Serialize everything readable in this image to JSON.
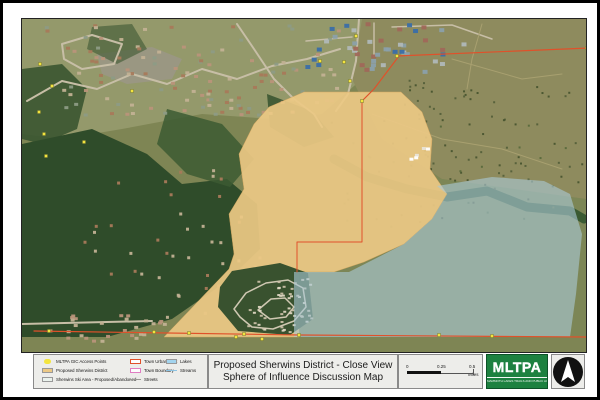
{
  "title_block": {
    "line1": "Proposed Sherwins District - Close View",
    "line2": "Sphere of Influence Discussion Map"
  },
  "legend": {
    "columns": [
      {
        "items": [
          {
            "label": "MLTPA GIC Access Points",
            "swatch": "point",
            "color": "#f3e53e"
          },
          {
            "label": "Proposed Sherwins District",
            "swatch": "fill",
            "color": "#ecc985"
          },
          {
            "label": "Sherwins Ski Area - Proposed/Abandoned",
            "swatch": "fill",
            "color": "#eaf2ec"
          }
        ]
      },
      {
        "items": [
          {
            "label": "Town Urban Limit",
            "swatch": "outline",
            "color": "#e0512a"
          },
          {
            "label": "Town Boundary",
            "swatch": "outline",
            "color": "#e07ec2"
          },
          {
            "label": "Streets",
            "swatch": "line",
            "color": "#9a9a94"
          }
        ]
      },
      {
        "items": [
          {
            "label": "Lakes",
            "swatch": "fill",
            "color": "#a3d4ee"
          },
          {
            "label": "Streams",
            "swatch": "line",
            "color": "#8cc3e2"
          }
        ]
      }
    ]
  },
  "scale_bar": {
    "labels": [
      "0",
      "0.25",
      "0.5"
    ],
    "unit": "Miles"
  },
  "logo": {
    "text": "MLTPA",
    "subtext": "MAMMOTH LAKES TRAILS AND PUBLIC ACCESS",
    "bg": "#1d8140"
  },
  "north_arrow": {
    "name": "north-arrow"
  },
  "colors": {
    "district_fill": "#ecc985",
    "ski_area_fill": "#aac8d5",
    "urban_limit_line": "#e0512a",
    "access_point": "#f3e53e",
    "forest": "#2f4c2a",
    "scrub": "#8e8b5e"
  },
  "map": {
    "width": 564,
    "height": 333,
    "layers": [
      {
        "t": "rect",
        "x": 0,
        "y": 0,
        "w": 564,
        "h": 333,
        "fill": "#7e8554"
      },
      {
        "t": "poly",
        "pts": [
          [
            0,
            0
          ],
          [
            360,
            0
          ],
          [
            340,
            60
          ],
          [
            300,
            95
          ],
          [
            250,
            100
          ],
          [
            180,
            95
          ],
          [
            100,
            110
          ],
          [
            40,
            120
          ],
          [
            0,
            115
          ]
        ],
        "fill": "#94996b"
      },
      {
        "t": "poly",
        "pts": [
          [
            340,
            0
          ],
          [
            564,
            0
          ],
          [
            564,
            180
          ],
          [
            480,
            170
          ],
          [
            420,
            160
          ],
          [
            360,
            120
          ],
          [
            330,
            60
          ]
        ],
        "fill": "#8e8b5e"
      },
      {
        "t": "poly",
        "pts": [
          [
            300,
            150
          ],
          [
            420,
            160
          ],
          [
            564,
            180
          ],
          [
            564,
            318
          ],
          [
            272,
            318
          ],
          [
            272,
            200
          ]
        ],
        "fill": "#7c8656"
      },
      {
        "t": "poly",
        "pts": [
          [
            75,
            35
          ],
          [
            130,
            28
          ],
          [
            160,
            40
          ],
          [
            150,
            60
          ],
          [
            105,
            65
          ],
          [
            80,
            55
          ]
        ],
        "fill": "#9b9786",
        "opacity": 0.85
      },
      {
        "t": "poly",
        "pts": [
          [
            0,
            50
          ],
          [
            40,
            45
          ],
          [
            65,
            70
          ],
          [
            55,
            110
          ],
          [
            20,
            125
          ],
          [
            0,
            120
          ]
        ],
        "fill": "#3a5531",
        "opacity": 0.9
      },
      {
        "t": "poly",
        "pts": [
          [
            0,
            125
          ],
          [
            70,
            110
          ],
          [
            125,
            135
          ],
          [
            160,
            165
          ],
          [
            205,
            160
          ],
          [
            235,
            185
          ],
          [
            238,
            230
          ],
          [
            205,
            262
          ],
          [
            150,
            300
          ],
          [
            85,
            318
          ],
          [
            0,
            318
          ]
        ],
        "fill": "#2f4c2a"
      },
      {
        "t": "poly",
        "pts": [
          [
            145,
            90
          ],
          [
            200,
            105
          ],
          [
            232,
            140
          ],
          [
            208,
            168
          ],
          [
            165,
            155
          ],
          [
            135,
            125
          ]
        ],
        "fill": "#3c5a33",
        "opacity": 0.85
      },
      {
        "t": "poly",
        "pts": [
          [
            245,
            75
          ],
          [
            290,
            92
          ],
          [
            312,
            118
          ],
          [
            282,
            128
          ],
          [
            248,
            108
          ]
        ],
        "fill": "#36522e",
        "opacity": 0.85
      },
      {
        "t": "poly",
        "pts": [
          [
            70,
            8
          ],
          [
            110,
            5
          ],
          [
            125,
            30
          ],
          [
            95,
            45
          ],
          [
            65,
            30
          ]
        ],
        "fill": "#49603a",
        "opacity": 0.7
      },
      {
        "t": "line",
        "pts": [
          [
            312,
            140
          ],
          [
            345,
            158
          ],
          [
            385,
            170
          ],
          [
            425,
            178
          ],
          [
            465,
            172
          ],
          [
            505,
            188
          ],
          [
            548,
            192
          ],
          [
            562,
            200
          ]
        ],
        "stroke": "#33552f",
        "sw": 9,
        "opacity": 0.9
      },
      {
        "t": "line",
        "pts": [
          [
            5,
            82
          ],
          [
            40,
            62
          ],
          [
            75,
            70
          ],
          [
            110,
            55
          ],
          [
            145,
            65
          ],
          [
            180,
            50
          ],
          [
            215,
            60
          ],
          [
            250,
            47
          ],
          [
            285,
            40
          ],
          [
            318,
            30
          ]
        ],
        "stroke": "#c7bea6",
        "sw": 2
      },
      {
        "t": "line",
        "pts": [
          [
            40,
            25
          ],
          [
            70,
            16
          ],
          [
            100,
            25
          ],
          [
            92,
            45
          ],
          [
            60,
            50
          ],
          [
            42,
            40
          ],
          [
            40,
            25
          ]
        ],
        "stroke": "#c7bea6",
        "sw": 2
      },
      {
        "t": "line",
        "pts": [
          [
            215,
            5
          ],
          [
            232,
            30
          ],
          [
            252,
            60
          ],
          [
            272,
            80
          ],
          [
            292,
            95
          ],
          [
            300,
            108
          ]
        ],
        "stroke": "#c7bea6",
        "sw": 2
      },
      {
        "t": "line",
        "pts": [
          [
            337,
            0
          ],
          [
            334,
            42
          ],
          [
            326,
            75
          ],
          [
            314,
            92
          ]
        ],
        "stroke": "#c7bea6",
        "sw": 2
      },
      {
        "t": "line",
        "pts": [
          [
            0,
            305
          ],
          [
            130,
            302
          ]
        ],
        "stroke": "#c7bea6",
        "sw": 2
      },
      {
        "t": "line",
        "pts": [
          [
            284,
            22
          ],
          [
            330,
            18
          ]
        ],
        "stroke": "#c7bea6",
        "sw": 1.5
      },
      {
        "t": "line",
        "pts": [
          [
            352,
            4
          ],
          [
            352,
            38
          ]
        ],
        "stroke": "#c7bea6",
        "sw": 1.5
      },
      {
        "t": "line",
        "pts": [
          [
            370,
            8
          ],
          [
            430,
            6
          ],
          [
            470,
            20
          ]
        ],
        "stroke": "#c7bea6",
        "sw": 1.5
      },
      {
        "t": "line",
        "pts": [
          [
            430,
            40
          ],
          [
            500,
            60
          ],
          [
            540,
            55
          ]
        ],
        "stroke": "#a8a070",
        "sw": 1
      },
      {
        "t": "line",
        "pts": [
          [
            350,
            95
          ],
          [
            420,
            120
          ],
          [
            480,
            130
          ],
          [
            540,
            150
          ]
        ],
        "stroke": "#a8a070",
        "sw": 1
      },
      {
        "t": "line",
        "pts": [
          [
            460,
            5
          ],
          [
            450,
            40
          ],
          [
            445,
            70
          ]
        ],
        "stroke": "#a8a070",
        "sw": 1
      },
      {
        "t": "scatter",
        "x": 20,
        "y": 5,
        "w": 300,
        "h": 90,
        "n": 120,
        "size": [
          4,
          3
        ],
        "colors": [
          "#a8795a",
          "#c2b193",
          "#8d9b85",
          "#b9937a"
        ],
        "seed": 7
      },
      {
        "t": "scatter",
        "x": 282,
        "y": 2,
        "w": 160,
        "h": 50,
        "n": 45,
        "size": [
          5,
          4
        ],
        "colors": [
          "#8ba0aa",
          "#b0b8b8",
          "#a06858",
          "#3a6ea8"
        ],
        "seed": 11
      },
      {
        "t": "scatter",
        "x": 60,
        "y": 150,
        "w": 180,
        "h": 150,
        "n": 45,
        "size": [
          3,
          3
        ],
        "colors": [
          "#c2b193",
          "#a8795a"
        ],
        "seed": 3
      },
      {
        "t": "scatter",
        "x": 15,
        "y": 295,
        "w": 135,
        "h": 26,
        "n": 28,
        "size": [
          4,
          3
        ],
        "colors": [
          "#b9937a",
          "#c2b193"
        ],
        "seed": 5
      },
      {
        "t": "scatter",
        "x": 380,
        "y": 60,
        "w": 180,
        "h": 110,
        "n": 70,
        "size": [
          2,
          2
        ],
        "colors": [
          "#55603a",
          "#49552f"
        ],
        "seed": 13
      },
      {
        "t": "scatter",
        "x": 300,
        "y": 100,
        "w": 250,
        "h": 110,
        "n": 40,
        "size": [
          2,
          2
        ],
        "colors": [
          "#4a5530",
          "#5a6a3c"
        ],
        "seed": 21
      },
      {
        "t": "poly",
        "pts": [
          [
            282,
            73
          ],
          [
            379,
            73
          ],
          [
            400,
            93
          ],
          [
            410,
            120
          ],
          [
            408,
            150
          ],
          [
            425,
            175
          ],
          [
            410,
            200
          ],
          [
            382,
            225
          ],
          [
            342,
            243
          ],
          [
            312,
            253
          ],
          [
            277,
            253
          ],
          [
            277,
            318
          ],
          [
            142,
            318
          ],
          [
            207,
            250
          ],
          [
            212,
            235
          ],
          [
            207,
            195
          ],
          [
            222,
            170
          ],
          [
            217,
            135
          ],
          [
            232,
            105
          ],
          [
            247,
            88
          ]
        ],
        "fill": "#ecc985",
        "opacity": 0.92,
        "stroke": "#d8a860",
        "sw": 0.5
      },
      {
        "t": "scatter",
        "x": 385,
        "y": 125,
        "w": 28,
        "h": 18,
        "n": 5,
        "size": [
          4,
          3
        ],
        "colors": [
          "#ffffff",
          "#e8e4d8"
        ],
        "seed": 17
      },
      {
        "t": "poly",
        "pts": [
          [
            210,
            252
          ],
          [
            258,
            244
          ],
          [
            286,
            254
          ],
          [
            291,
            300
          ],
          [
            268,
            316
          ],
          [
            216,
            312
          ],
          [
            196,
            288
          ],
          [
            198,
            268
          ]
        ],
        "fill": "#2f4c2a",
        "opacity": 0.95
      },
      {
        "t": "line",
        "pts": [
          [
            212,
            290
          ],
          [
            224,
            274
          ],
          [
            244,
            264
          ],
          [
            266,
            261
          ],
          [
            281,
            269
          ],
          [
            284,
            288
          ],
          [
            272,
            302
          ],
          [
            251,
            310
          ],
          [
            230,
            308
          ],
          [
            218,
            298
          ],
          [
            212,
            290
          ]
        ],
        "stroke": "#cfc8b2",
        "sw": 1.5
      },
      {
        "t": "line",
        "pts": [
          [
            236,
            291
          ],
          [
            249,
            280
          ],
          [
            263,
            279
          ],
          [
            272,
            288
          ],
          [
            264,
            298
          ],
          [
            248,
            300
          ],
          [
            236,
            291
          ]
        ],
        "stroke": "#cfc8b2",
        "sw": 1.5
      },
      {
        "t": "scatter",
        "x": 222,
        "y": 258,
        "w": 68,
        "h": 55,
        "n": 50,
        "size": [
          3,
          2
        ],
        "colors": [
          "#ded6c2",
          "#c9bfa6"
        ],
        "seed": 9
      },
      {
        "t": "poly",
        "pts": [
          [
            415,
            167
          ],
          [
            470,
            158
          ],
          [
            522,
            162
          ],
          [
            548,
            175
          ],
          [
            560,
            215
          ],
          [
            554,
            275
          ],
          [
            548,
            318
          ],
          [
            272,
            318
          ],
          [
            272,
            253
          ],
          [
            327,
            253
          ],
          [
            382,
            225
          ],
          [
            410,
            200
          ],
          [
            425,
            175
          ]
        ],
        "fill": "#aac8d5",
        "opacity": 0.62
      },
      {
        "t": "line",
        "pts": [
          [
            375,
            37
          ],
          [
            567,
            29
          ]
        ],
        "stroke": "#e0512a",
        "sw": 1.2
      },
      {
        "t": "line",
        "pts": [
          [
            377,
            37
          ],
          [
            352,
            70
          ],
          [
            340,
            82
          ]
        ],
        "stroke": "#e0512a",
        "sw": 1.2
      },
      {
        "t": "line",
        "pts": [
          [
            340,
            82
          ],
          [
            340,
            223
          ],
          [
            275,
            223
          ],
          [
            275,
            253
          ]
        ],
        "stroke": "#e0512a",
        "sw": 1
      },
      {
        "t": "line",
        "pts": [
          [
            12,
            312
          ],
          [
            277,
            316
          ],
          [
            564,
            318
          ]
        ],
        "stroke": "#e0512a",
        "sw": 1.2
      },
      {
        "t": "pts",
        "size": 3,
        "fill": "#f3e53e",
        "stroke": "#7a7a30",
        "pts": [
          [
            375,
            37
          ],
          [
            565,
            29
          ],
          [
            18,
            45
          ],
          [
            30,
            67
          ],
          [
            17,
            93
          ],
          [
            22,
            115
          ],
          [
            24,
            137
          ],
          [
            62,
            123
          ],
          [
            110,
            72
          ],
          [
            334,
            17
          ],
          [
            298,
            42
          ],
          [
            322,
            43
          ],
          [
            328,
            62
          ],
          [
            340,
            82
          ],
          [
            27,
            312
          ],
          [
            132,
            313
          ],
          [
            167,
            314
          ],
          [
            222,
            315
          ],
          [
            277,
            316
          ],
          [
            417,
            316
          ],
          [
            470,
            317
          ],
          [
            214,
            318
          ],
          [
            240,
            320
          ]
        ]
      }
    ]
  }
}
